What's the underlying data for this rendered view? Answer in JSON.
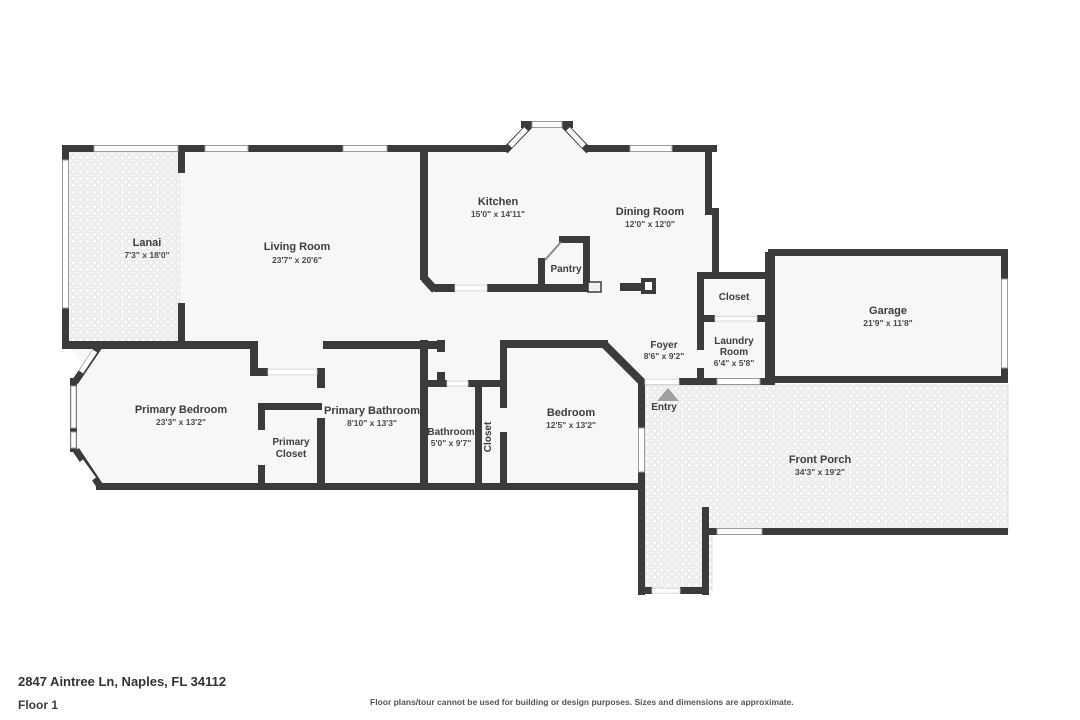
{
  "footer": {
    "address": "2847 Aintree Ln, Naples, FL 34112",
    "floor_label": "Floor 1",
    "disclaimer": "Floor plans/tour cannot be used for building or design purposes. Sizes and dimensions are approximate."
  },
  "colors": {
    "wall": "#3b3b3b",
    "room_fill": "#f7f7f7",
    "outdoor_tile": "#f3f3f3",
    "entry_arrow": "#a0a0a0",
    "text": "#3d3d3d"
  },
  "rooms": {
    "lanai": {
      "name": "Lanai",
      "dims": "7'3\" x 18'0\""
    },
    "living_room": {
      "name": "Living Room",
      "dims": "23'7\" x 20'6\""
    },
    "kitchen": {
      "name": "Kitchen",
      "dims": "15'0\" x 14'11\""
    },
    "dining_room": {
      "name": "Dining Room",
      "dims": "12'0\" x 12'0\""
    },
    "pantry": {
      "name": "Pantry"
    },
    "closet_garage": {
      "name": "Closet"
    },
    "garage": {
      "name": "Garage",
      "dims": "21'9\" x 11'8\""
    },
    "foyer": {
      "name": "Foyer",
      "dims": "8'6\" x 9'2\""
    },
    "laundry": {
      "line1": "Laundry",
      "line2": "Room",
      "dims": "6'4\" x 5'8\""
    },
    "entry": {
      "name": "Entry"
    },
    "primary_bedroom": {
      "name": "Primary Bedroom",
      "dims": "23'3\" x 13'2\""
    },
    "primary_closet": {
      "line1": "Primary",
      "line2": "Closet"
    },
    "primary_bathroom": {
      "name": "Primary Bathroom",
      "dims": "8'10\" x 13'3\""
    },
    "bathroom": {
      "name": "Bathroom",
      "dims": "5'0\" x 9'7\""
    },
    "closet_hall": {
      "name": "Closet"
    },
    "closet_bedroom": {
      "name": "Closet"
    },
    "bedroom": {
      "name": "Bedroom",
      "dims": "12'5\" x 13'2\""
    },
    "front_porch": {
      "name": "Front Porch",
      "dims": "34'3\" x 19'2\""
    }
  }
}
